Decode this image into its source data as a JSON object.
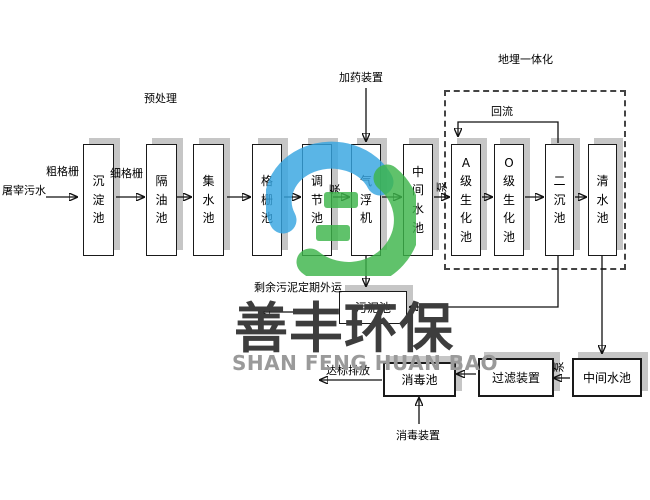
{
  "labels": {
    "source": "屠宰污水",
    "coarse_screen": "粗格栅",
    "fine_screen": "细格栅",
    "pretreatment": "预处理",
    "dosing_device": "加药装置",
    "buried_integrated": "地埋一体化",
    "backflow": "回流",
    "pump1": "泵",
    "pump2": "泵",
    "pump3": "泵",
    "sludge_outbound": "剩余污泥定期外运",
    "standard_discharge": "达标排放",
    "disinfection_device": "消毒装置"
  },
  "tanks": {
    "sedimentation": "沉淀池",
    "oil_separator": "隔油池",
    "collecting": "集水池",
    "screen_tank": "格栅池",
    "regulating": "调节池",
    "air_flotation": "气浮机",
    "intermediate_1": "中间水池",
    "a_bio": "A级生化池",
    "o_bio": "O级生化池",
    "secondary_sed": "二沉池",
    "clear_water": "清水池",
    "sludge": "污泥池",
    "disinfection": "消毒池",
    "filter_device": "过滤装置",
    "intermediate_2": "中间水池"
  },
  "watermark": {
    "cn": "善丰环保",
    "en": "SHAN FENG HUAN BAO",
    "logo_blue": "#36a5e0",
    "logo_green": "#3db54a",
    "cn_color": "#3d3d3d",
    "en_color": "#9a9a9a"
  }
}
